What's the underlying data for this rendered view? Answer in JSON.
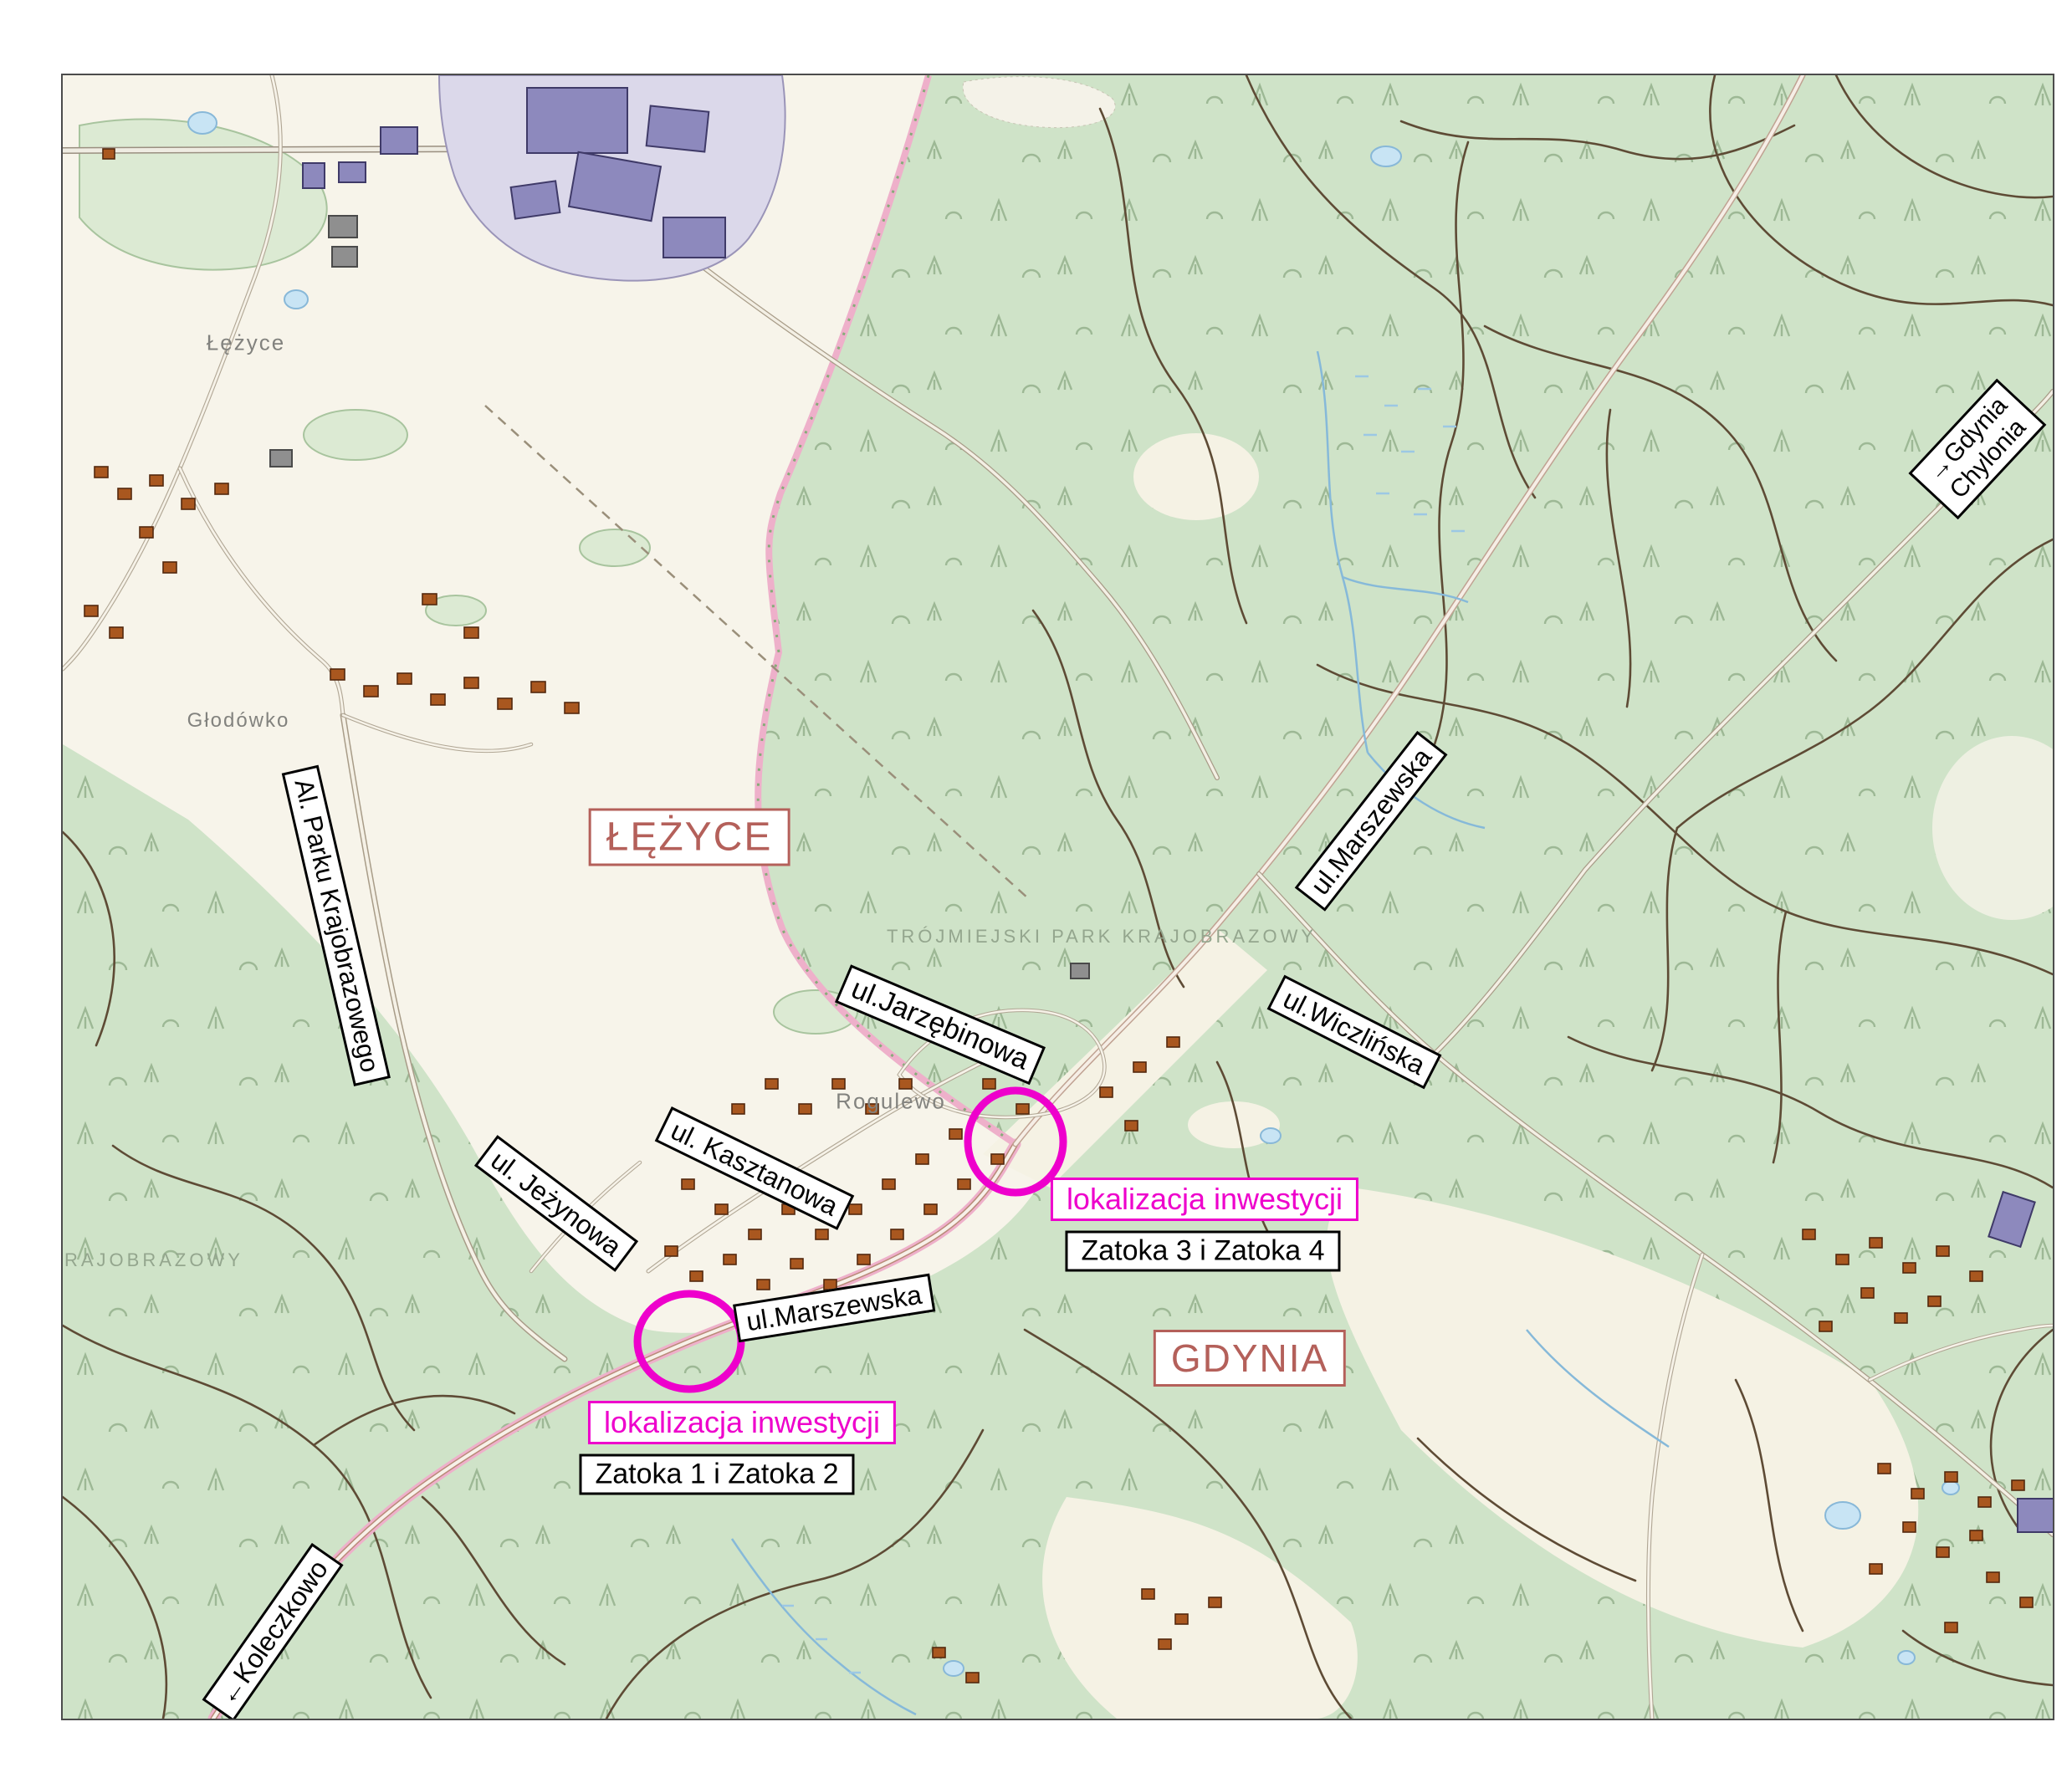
{
  "map": {
    "region_labels": {
      "lezyce_city": "ŁĘŻYCE",
      "gdynia_city": "GDYNIA",
      "park_name": "TRÓJMIEJSKI PARK KRAJOBRAZOWY",
      "park_name_partial": "RAJOBRAZOWY",
      "lezyce_village": "Łężyce",
      "glodowko_village": "Głodówko",
      "rogulewo_village": "Rogulewo"
    },
    "street_signs": {
      "al_parku": "Al. Parku Krajobrazowego",
      "marszewska_upper": "ul.Marszewska",
      "wiczlinska": "ul.Wiczlińska",
      "jarzebinowa": "ul.Jarzębinowa",
      "jezynowa": "ul. Jeżynowa",
      "kasztanowa": "ul. Kasztanowa",
      "marszewska_lower": "ul.Marszewska",
      "gdynia_chylonia_line1": "→Gdynia",
      "gdynia_chylonia_line2": "Chylonia",
      "koleczkowo": "←Koleczkowo"
    },
    "investment": {
      "label_1": "lokalizacja inwestycji",
      "sublabel_1": "Zatoka 1 i Zatoka 2",
      "label_2": "lokalizacja inwestycji",
      "sublabel_2": "Zatoka 3 i Zatoka 4"
    },
    "colors": {
      "forest": "#cfe3c8",
      "field": "#f6f3e6",
      "city_label": "#b4605a",
      "highlight_magenta": "#ee00cc",
      "road_dark": "#5e4b35",
      "boundary_pink": "#eeb0ca",
      "water": "#bcdff2",
      "industrial_area": "#dbd8ea",
      "building_purple": "#8d89bd",
      "building_orange": "#a9571f"
    }
  }
}
